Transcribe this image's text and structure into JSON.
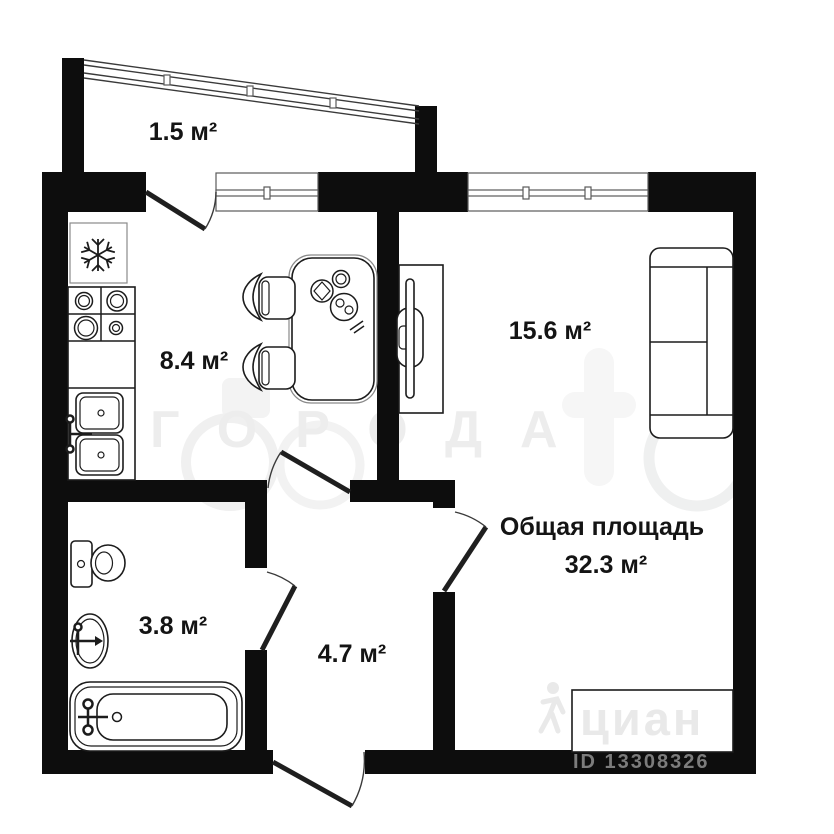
{
  "plan": {
    "rooms": {
      "balcony": {
        "area_label": "1.5 м²"
      },
      "kitchen": {
        "area_label": "8.4 м²"
      },
      "living_room": {
        "area_label": "15.6 м²"
      },
      "bathroom": {
        "area_label": "3.8 м²"
      },
      "hallway": {
        "area_label": "4.7 м²"
      }
    },
    "total": {
      "title": "Общая площадь",
      "value": "32.3 м²"
    },
    "watermarks": {
      "brand_text": "ГОРОДА",
      "cian_text": "циан",
      "listing_id": "ID 13308326"
    },
    "colors": {
      "wall_black": "#0d0d0d",
      "fixture_line": "#1c1c1c",
      "watermark_light": "#ededed",
      "listing_id_gray": "#7c7c7c"
    }
  }
}
